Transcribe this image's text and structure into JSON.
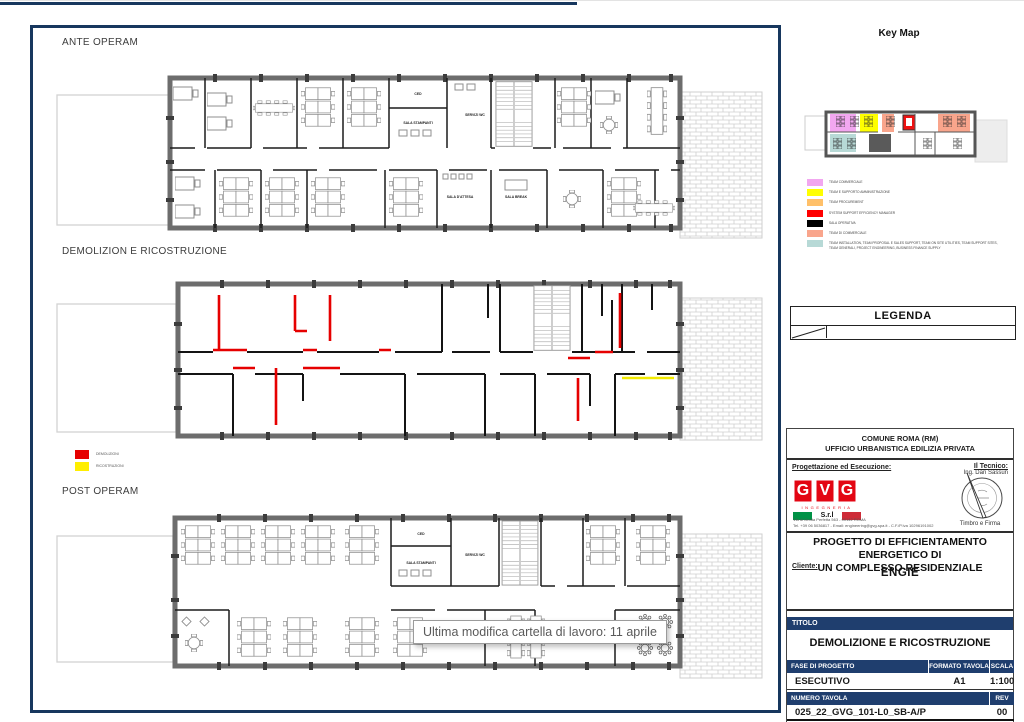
{
  "sections": {
    "ante": {
      "label": "ANTE OPERAM"
    },
    "demo": {
      "label": "DEMOLIZION E RICOSTRUZIONE"
    },
    "post": {
      "label": "POST OPERAM"
    }
  },
  "rooms": {
    "ced": "CED",
    "stampanti": "SALA STAMPANTI",
    "wc": "SERVIZI WC",
    "attesa": "SALA D'ATTESA",
    "break": "SALA BREAK"
  },
  "demo_legend": {
    "red_color": "#e60000",
    "red_label": "DEMOLIZIONI",
    "yellow_color": "#ffee00",
    "yellow_label": "RICOSTRUZIONI"
  },
  "tooltip": {
    "text": "Ultima modifica cartella di lavoro: 11 aprile"
  },
  "keymap": {
    "title": "Key Map",
    "legend": [
      {
        "color": "#f2a7f0",
        "label": "TEAM COMMERCIALE"
      },
      {
        "color": "#ffff00",
        "label": "TEAM E SUPPORTO AMMINISTRAZIONE"
      },
      {
        "color": "#ffc069",
        "label": "TEAM PROCUREMENT"
      },
      {
        "color": "#ff0000",
        "label": "SYSTEM SUPPORT EFFICIENCY MANAGER"
      },
      {
        "color": "#000000",
        "label": "SALA OPERATIVA"
      },
      {
        "color": "#f9a58c",
        "label": "TEAM DI COMMERCIALE"
      },
      {
        "color": "#b7d9d6",
        "label": "TEAM INSTALLATION, TEAM PROPOSAL E SALES SUPPORT, TEAM ON SITE UTILITIES, TEAM SUPPORT SITES, TEAM GENERALI, PROJECT ENGINEERING, BUSINESS FINANCE SUPPLY"
      }
    ]
  },
  "legenda": {
    "title": "LEGENDA"
  },
  "titleblock": {
    "authority_line1": "COMUNE ROMA (RM)",
    "authority_line2": "UFFICIO URBANISTICA EDILIZIA PRIVATA",
    "design_label": "Progettazione ed Esecuzione:",
    "tecnico_label": "Il Tecnico:",
    "tecnico_name": "Ing. Dan Sassun",
    "logo": {
      "letters": [
        "G",
        "V",
        "G"
      ],
      "sub": "INGEGNERIA",
      "srl": "S.r.l"
    },
    "address_line1": "Via di Grotta Perfetta 563 - 00142 ROMA",
    "address_line2": "Tel. +39 06 5036817 - Email: engineering@gvg-spa.it - C.F./P.Iva 10296191002",
    "stamp_caption": "Timbro e Firma",
    "project_title_line1": "PROGETTO DI EFFICIENTAMENTO ENERGETICO DI",
    "project_title_line2": "UN COMPLESSO RESIDENZIALE",
    "client_label": "Cliente:",
    "client_name": "ENGIE",
    "titolo_label": "TITOLO",
    "titolo_value": "DEMOLIZIONE E RICOSTRUZIONE",
    "table": {
      "fase_header": "FASE DI PROGETTO",
      "formato_header": "FORMATO TAVOLA",
      "scala_header": "SCALA",
      "fase_value": "ESECUTIVO",
      "formato_value": "A1",
      "scala_value": "1:100",
      "numero_header": "NUMERO TAVOLA",
      "rev_header": "REV",
      "numero_value": "025_22_GVG_101-L0_SB-A/P",
      "rev_value": "00"
    },
    "accent_navy": "#1f3e6e",
    "frame_navy": "#17375e"
  }
}
